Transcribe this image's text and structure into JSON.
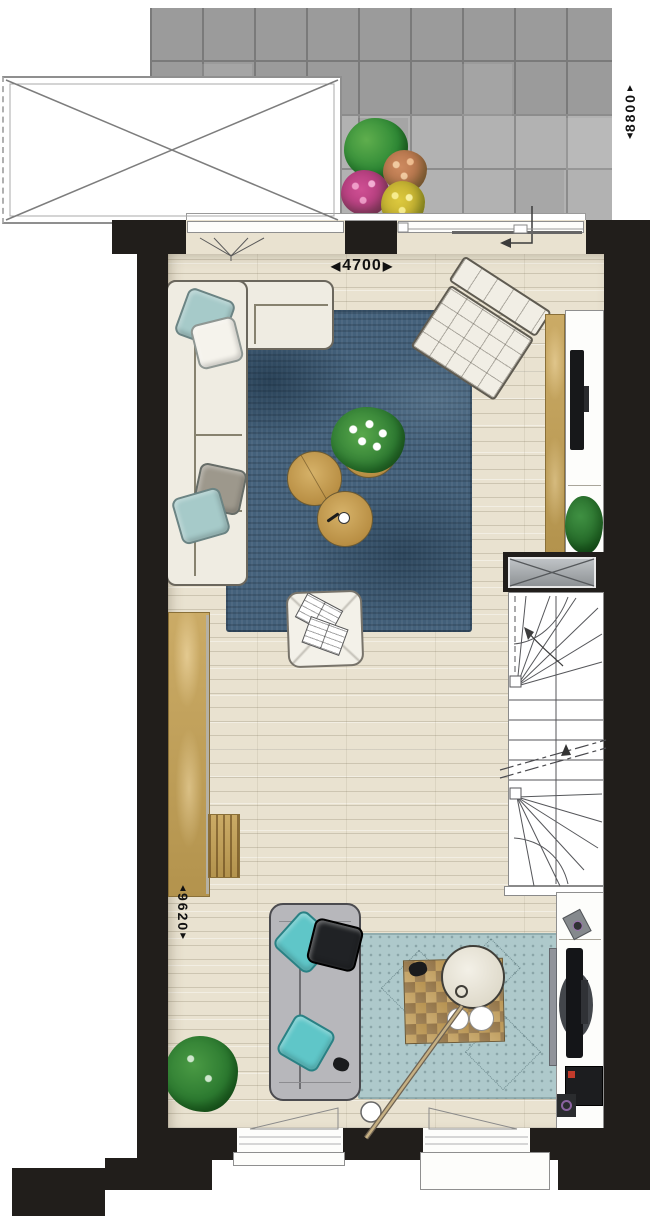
{
  "plan": {
    "type": "floor-plan",
    "dimensions": {
      "width": {
        "value": "4700",
        "prefix": "◀",
        "suffix": "▶"
      },
      "depth": {
        "value": "9620",
        "up": "▲",
        "down": "▼"
      },
      "terrace": {
        "value": "8800",
        "up": "▲",
        "down": "▼"
      }
    },
    "colors": {
      "wall": "#211e1b",
      "floor_wood": "#e9e2d0",
      "patio_tile": "#b2b2b2",
      "rug_dark_blue": "#44617b",
      "rug_light_blue": "#aec9cb",
      "accent_teal": "#5fc6c8",
      "pillow_soft_teal": "#a6cac9",
      "wood_furniture": "#c4a568",
      "sofa_cream": "#efece2",
      "sofa_gray": "#b7b7bb",
      "plant_green": "#2f7c33",
      "flower_pink": "#cf4f93",
      "flower_yellow": "#ddc93e",
      "flower_salmon": "#cd8a5f"
    }
  }
}
